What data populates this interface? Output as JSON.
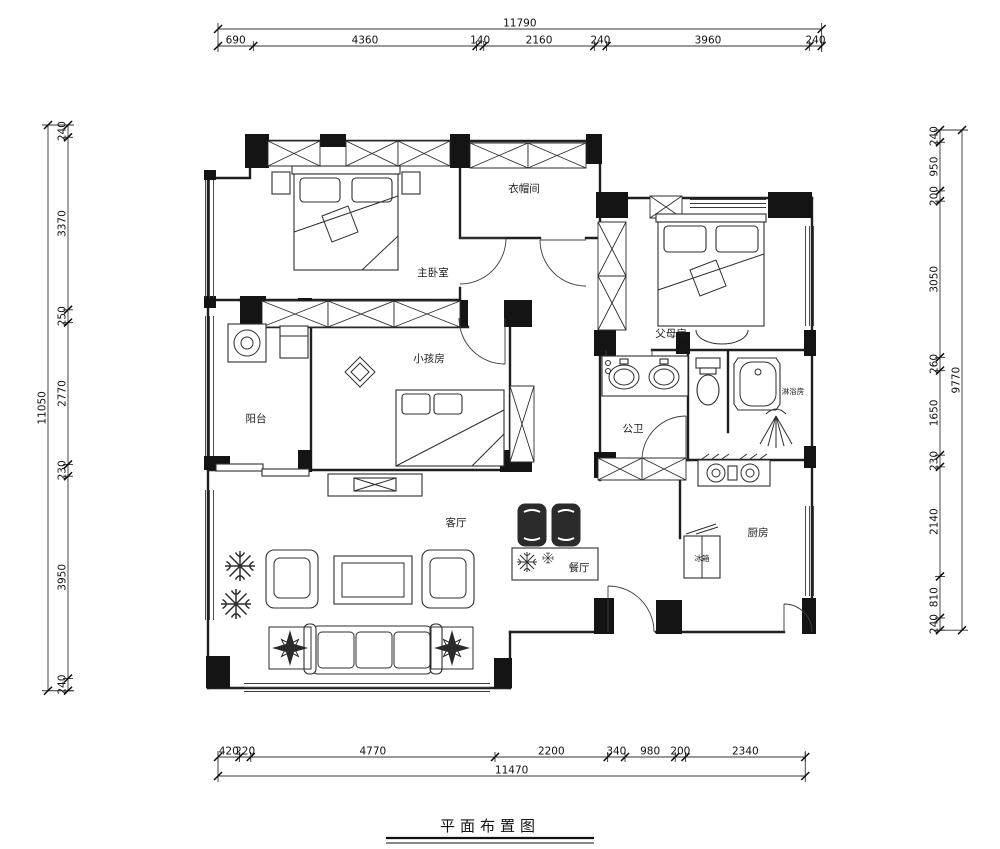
{
  "title": {
    "text": "平面布置图"
  },
  "rooms": [
    {
      "name": "master-bedroom",
      "label": "主卧室"
    },
    {
      "name": "walk-in-closet",
      "label": "衣帽间"
    },
    {
      "name": "parents-room",
      "label": "父母房"
    },
    {
      "name": "kids-room",
      "label": "小孩房"
    },
    {
      "name": "balcony",
      "label": "阳台"
    },
    {
      "name": "public-bathroom",
      "label": "公卫"
    },
    {
      "name": "shower-room",
      "label": "淋浴房"
    },
    {
      "name": "living-room",
      "label": "客厅"
    },
    {
      "name": "dining-room",
      "label": "餐厅"
    },
    {
      "name": "kitchen",
      "label": "厨房"
    },
    {
      "name": "fridge",
      "label": "冰箱"
    }
  ],
  "dimension_chains": {
    "top": {
      "overall": "11790",
      "segments": [
        "690",
        "4360",
        "140",
        "2160",
        "240",
        "3960",
        "240"
      ]
    },
    "bottom": {
      "overall": "11470",
      "segments": [
        "420",
        "220",
        "4770",
        "2200",
        "340",
        "980",
        "200",
        "2340"
      ]
    },
    "left": {
      "overall": "11050",
      "segments": [
        "240",
        "3370",
        "250",
        "2770",
        "230",
        "3950",
        "240"
      ]
    },
    "right": {
      "overall": "9770",
      "segments": [
        "240",
        "950",
        "200",
        "3050",
        "260",
        "1650",
        "230",
        "2140",
        "810",
        "240"
      ]
    }
  },
  "colors": {
    "line": "#1f1f1f",
    "wall_fill": "#141414",
    "background": "#ffffff"
  }
}
